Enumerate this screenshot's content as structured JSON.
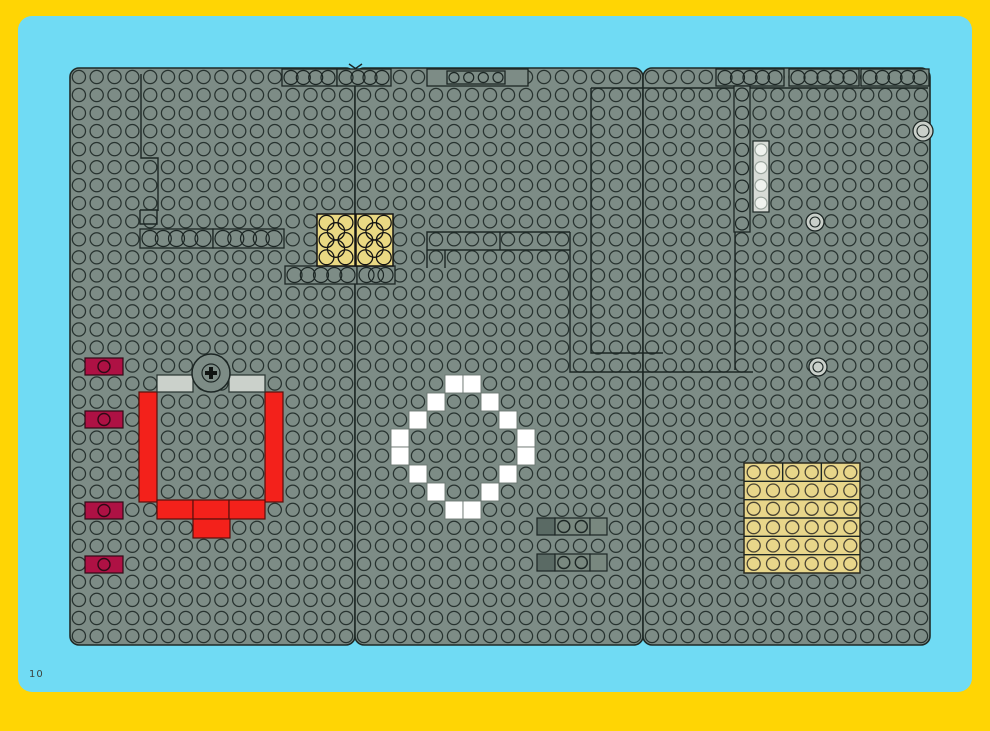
{
  "page": {
    "number": "10"
  },
  "colors": {
    "frame_yellow": "#ffd504",
    "cyan": "#70dbf4",
    "baseplate": "#7d8c86",
    "plate_edge": "#1f2a27",
    "stud_line": "#27322f",
    "outline": "#1c2624",
    "red": "#f3211b",
    "red_edge": "#58100d",
    "maroon": "#ae1144",
    "maroon_edge": "#300a16",
    "light_gray": "#cbd1cb",
    "lighter_gray": "#d7dbd6",
    "white": "#ffffff",
    "white_edge": "#6b7670",
    "yellow_brick": "#ead983",
    "tan": "#e8d68a",
    "dark_tile": "#5a6a64",
    "mid_tile": "#79887f",
    "round_fill": "#c9cfc9"
  },
  "frame": {
    "x": 0,
    "y": 0,
    "w": 990,
    "h": 727
  },
  "cyan_panel": {
    "x": 18,
    "y": 16,
    "w": 954,
    "h": 676,
    "r": 14
  },
  "board": {
    "y": 68,
    "h": 577,
    "rows": 32,
    "cols": 16,
    "corner_r": 9,
    "plates": [
      {
        "x": 70,
        "w": 285
      },
      {
        "x": 355,
        "w": 288
      },
      {
        "x": 643,
        "w": 287
      }
    ]
  },
  "seam_marks": [
    [
      [
        349,
        64
      ],
      [
        362,
        73
      ]
    ],
    [
      [
        362,
        64
      ],
      [
        349,
        73
      ]
    ]
  ],
  "outlines": [
    [
      [
        141,
        74
      ],
      [
        141,
        158
      ],
      [
        158,
        158
      ],
      [
        158,
        211
      ]
    ],
    [
      [
        140,
        210
      ],
      [
        157,
        210
      ],
      [
        157,
        224
      ],
      [
        140,
        224
      ],
      [
        140,
        210
      ]
    ],
    [
      [
        570,
        232
      ],
      [
        427,
        232
      ],
      [
        427,
        268
      ]
    ],
    [
      [
        427,
        250
      ],
      [
        570,
        250
      ]
    ],
    [
      [
        500,
        232
      ],
      [
        500,
        250
      ]
    ],
    [
      [
        445,
        250
      ],
      [
        445,
        268
      ]
    ],
    [
      [
        591,
        88
      ],
      [
        928,
        88
      ]
    ],
    [
      [
        591,
        88
      ],
      [
        591,
        353
      ],
      [
        663,
        353
      ]
    ],
    [
      [
        570,
        232
      ],
      [
        570,
        372
      ],
      [
        753,
        372
      ]
    ],
    [
      [
        735,
        88
      ],
      [
        735,
        370
      ]
    ]
  ],
  "ring_strips": [
    {
      "name": "plate-1x4-a",
      "x": 140,
      "y": 229,
      "w": 73,
      "h": 19,
      "rings": 5,
      "vertical": false
    },
    {
      "name": "plate-1x4-b",
      "x": 213,
      "y": 229,
      "w": 71,
      "h": 19,
      "rings": 5,
      "vertical": false
    },
    {
      "name": "plate-top-a",
      "x": 282,
      "y": 69,
      "w": 55,
      "h": 17,
      "rings": 4,
      "vertical": false
    },
    {
      "name": "plate-top-b",
      "x": 337,
      "y": 69,
      "w": 54,
      "h": 17,
      "rings": 4,
      "vertical": false
    },
    {
      "name": "plate-top-c-box",
      "x": 427,
      "y": 69,
      "w": 101,
      "h": 17,
      "rings": 0,
      "vertical": false
    },
    {
      "name": "plate-top-c",
      "x": 447,
      "y": 71,
      "w": 58,
      "h": 13,
      "rings": 4,
      "vertical": false
    },
    {
      "name": "plate-top-d",
      "x": 716,
      "y": 69,
      "w": 68,
      "h": 17,
      "rings": 5,
      "vertical": false
    },
    {
      "name": "plate-top-e",
      "x": 789,
      "y": 69,
      "w": 70,
      "h": 17,
      "rings": 5,
      "vertical": false
    },
    {
      "name": "plate-top-f",
      "x": 861,
      "y": 69,
      "w": 68,
      "h": 17,
      "rings": 5,
      "vertical": false
    },
    {
      "name": "plate-under-yellow-a",
      "x": 285,
      "y": 266,
      "w": 72,
      "h": 18,
      "rings": 5,
      "vertical": false
    },
    {
      "name": "plate-under-yellow-b",
      "x": 357,
      "y": 266,
      "w": 38,
      "h": 18,
      "rings": 3,
      "vertical": false
    },
    {
      "name": "plate-1x8-vertical",
      "x": 734,
      "y": 86,
      "w": 16,
      "h": 146,
      "rings": 8,
      "vertical": true
    }
  ],
  "pieces": [
    {
      "type": "rect",
      "name": "red-brick-left-1x6",
      "x": 139,
      "y": 392,
      "w": 18,
      "h": 110,
      "fill": "red",
      "stroke": "red_edge"
    },
    {
      "type": "rect",
      "name": "red-brick-right-1x6",
      "x": 265,
      "y": 392,
      "w": 18,
      "h": 110,
      "fill": "red",
      "stroke": "red_edge"
    },
    {
      "type": "rect",
      "name": "red-brick-bottom-a",
      "x": 157,
      "y": 500,
      "w": 36,
      "h": 19,
      "fill": "red",
      "stroke": "red_edge"
    },
    {
      "type": "rect",
      "name": "red-brick-bottom-b",
      "x": 193,
      "y": 500,
      "w": 36,
      "h": 19,
      "fill": "red",
      "stroke": "red_edge"
    },
    {
      "type": "rect",
      "name": "red-brick-bottom-c",
      "x": 229,
      "y": 500,
      "w": 36,
      "h": 19,
      "fill": "red",
      "stroke": "red_edge"
    },
    {
      "type": "rect",
      "name": "red-brick-bottom-tab",
      "x": 193,
      "y": 519,
      "w": 37,
      "h": 19,
      "fill": "red",
      "stroke": "red_edge"
    },
    {
      "type": "rect",
      "name": "gray-tile-1x2-a",
      "x": 157,
      "y": 375,
      "w": 36,
      "h": 17,
      "fill": "light_gray",
      "stroke": "stud_line"
    },
    {
      "type": "rect",
      "name": "gray-tile-1x2-b",
      "x": 229,
      "y": 375,
      "w": 36,
      "h": 17,
      "fill": "light_gray",
      "stroke": "stud_line"
    },
    {
      "type": "stud-rect",
      "name": "darkred-jumper-1",
      "x": 85,
      "y": 358,
      "w": 38,
      "h": 17,
      "fill": "maroon",
      "stroke": "maroon_edge",
      "studs": 1
    },
    {
      "type": "stud-rect",
      "name": "darkred-jumper-2",
      "x": 85,
      "y": 411,
      "w": 38,
      "h": 17,
      "fill": "maroon",
      "stroke": "maroon_edge",
      "studs": 1
    },
    {
      "type": "stud-rect",
      "name": "darkred-jumper-3",
      "x": 85,
      "y": 502,
      "w": 38,
      "h": 17,
      "fill": "maroon",
      "stroke": "maroon_edge",
      "studs": 1
    },
    {
      "type": "stud-rect",
      "name": "darkred-jumper-4",
      "x": 85,
      "y": 556,
      "w": 38,
      "h": 17,
      "fill": "maroon",
      "stroke": "maroon_edge",
      "studs": 1
    },
    {
      "type": "rect",
      "name": "dark-tile-1x1-a",
      "x": 537,
      "y": 518,
      "w": 18,
      "h": 17,
      "fill": "dark_tile",
      "stroke": "outline"
    },
    {
      "type": "stud-rect",
      "name": "plate-1x2-a",
      "x": 555,
      "y": 518,
      "w": 35,
      "h": 17,
      "fill": "mid_tile",
      "stroke": "outline",
      "studs": 2
    },
    {
      "type": "rect",
      "name": "flat-tile-1x1-a",
      "x": 590,
      "y": 518,
      "w": 17,
      "h": 17,
      "fill": "mid_tile",
      "stroke": "outline"
    },
    {
      "type": "rect",
      "name": "dark-tile-1x1-b",
      "x": 537,
      "y": 554,
      "w": 18,
      "h": 17,
      "fill": "dark_tile",
      "stroke": "outline"
    },
    {
      "type": "stud-rect",
      "name": "plate-1x2-b",
      "x": 555,
      "y": 554,
      "w": 35,
      "h": 17,
      "fill": "mid_tile",
      "stroke": "outline",
      "studs": 2
    },
    {
      "type": "rect",
      "name": "flat-tile-1x1-b",
      "x": 590,
      "y": 554,
      "w": 17,
      "h": 17,
      "fill": "mid_tile",
      "stroke": "outline"
    },
    {
      "type": "vstud-rect",
      "name": "lightgray-plate-1x4-vertical",
      "x": 753,
      "y": 141,
      "w": 16,
      "h": 71,
      "fill": "lighter_gray",
      "stroke": "outline",
      "studs": 4
    }
  ],
  "white_ring": {
    "tile": 18,
    "positions": [
      [
        445,
        375
      ],
      [
        463,
        375
      ],
      [
        427,
        393
      ],
      [
        481,
        393
      ],
      [
        409,
        411
      ],
      [
        499,
        411
      ],
      [
        391,
        429
      ],
      [
        517,
        429
      ],
      [
        391,
        447
      ],
      [
        517,
        447
      ],
      [
        409,
        465
      ],
      [
        499,
        465
      ],
      [
        427,
        483
      ],
      [
        481,
        483
      ],
      [
        445,
        501
      ],
      [
        463,
        501
      ]
    ]
  },
  "yellow_bricks": [
    {
      "name": "yellow-brick-2x3-a",
      "x": 317,
      "y": 214,
      "w": 38,
      "h": 52
    },
    {
      "name": "yellow-brick-2x3-b",
      "x": 356,
      "y": 214,
      "w": 37,
      "h": 52
    }
  ],
  "tan_square": {
    "name": "tan-plates-6x6",
    "x": 744,
    "y": 463,
    "w": 116,
    "h": 110,
    "rows": 6,
    "cols": 6,
    "top_row_splits": 3
  },
  "turntable": {
    "name": "turntable-2x2",
    "cx": 211,
    "cy": 373,
    "r": 19,
    "inner_r": 9
  },
  "rounds": [
    {
      "name": "round-plate-a",
      "cx": 923,
      "cy": 131,
      "r": 10
    },
    {
      "name": "round-plate-b",
      "cx": 815,
      "cy": 222,
      "r": 9
    },
    {
      "name": "round-plate-c",
      "cx": 818,
      "cy": 367,
      "r": 9
    }
  ]
}
